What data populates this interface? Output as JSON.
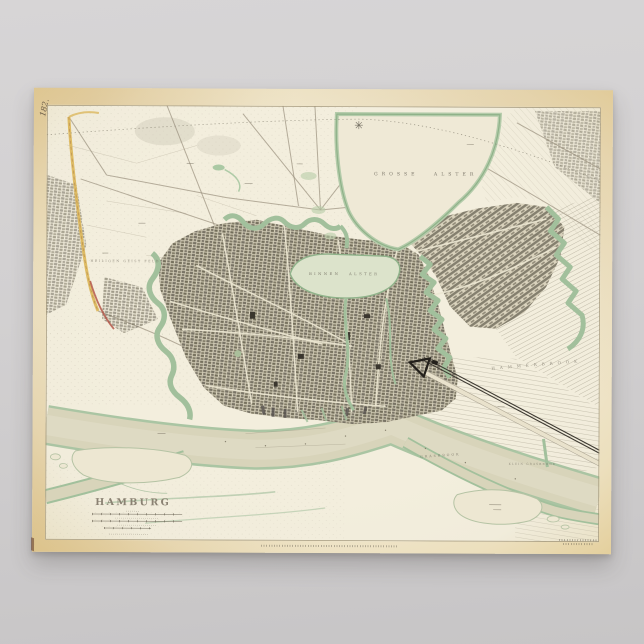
{
  "poster": {
    "handwritten_number": "182.",
    "map": {
      "title": "HAMBURG",
      "labels": {
        "grosse_alster": "GROSSE ALSTER",
        "binnen_alster": "BINNEN ALSTER",
        "hammerbrook": "HAMMERBROOK",
        "grasbrook": "GRASBROOK",
        "klein_grasbrook": "KLEIN GRASBROOK",
        "heiligen_geist_feld": "HEILIGEN GEIST FELD"
      }
    }
  },
  "colors": {
    "backdrop": "#d7d5d6",
    "backdropdark": "#c7c5c6",
    "paper": "#ecdfbd",
    "paperedge": "#e2cc96",
    "plate": "#f1ecdb",
    "bank": "#a2c09c",
    "river": "#d8d4ba",
    "lake": "#efe9d6",
    "binnen": "#dce3cb",
    "citydark": "#6e695c",
    "citybase": "#d3ccb6",
    "ink": "#6b665a",
    "titleink": "#8a8172",
    "yellow": "#dcb85e",
    "red": "#b4574a",
    "rail": "#3f3b33"
  }
}
